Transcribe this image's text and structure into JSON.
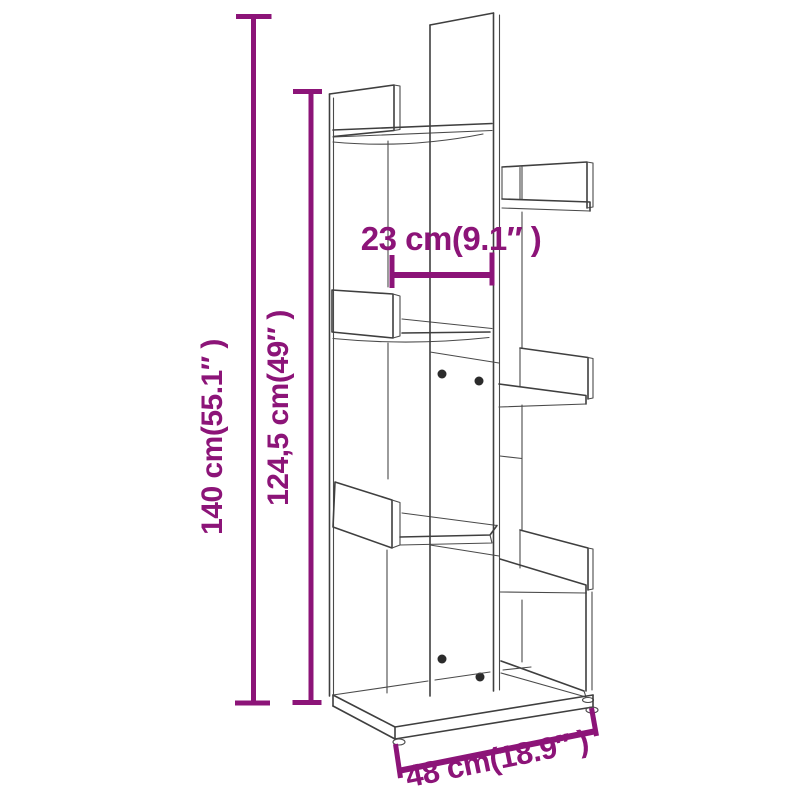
{
  "page": {
    "background": "#ffffff",
    "description": "Dimension diagram of a tree-style bookshelf"
  },
  "diagram": {
    "drawing_color": "#3f3f3f",
    "dimension_color": "#8C1478",
    "dimensions": {
      "total_height": "140 cm(55.1″ )",
      "upper_height": "124,5 cm(49″ )",
      "shelf_depth": "23 cm(9.1″ )",
      "base_width": "48 cm(18.9″ )"
    }
  }
}
